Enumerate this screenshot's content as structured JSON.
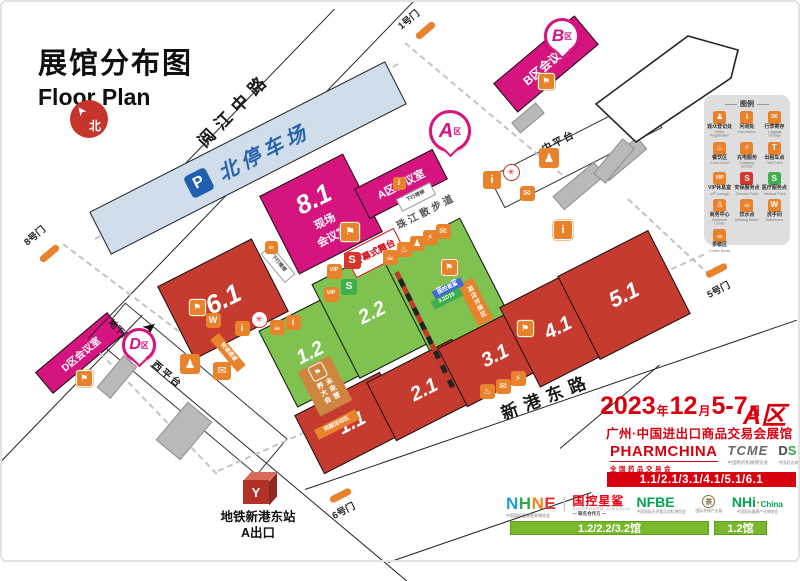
{
  "title": {
    "zh": "展馆分布图",
    "en": "Floor Plan"
  },
  "compass": "北",
  "roads": {
    "yuejiang": "阅江中路",
    "xingang": "新港东路",
    "promenade": "珠江散步道",
    "west_platform": "西平台",
    "mid_platform": "中平台",
    "underground_parking": "地下停车场"
  },
  "parking": {
    "p": "P",
    "label": "北停车场"
  },
  "map": {
    "hall81": "8.1",
    "halls": [
      {
        "label": "6.1",
        "color": "red"
      },
      {
        "label": "1.2",
        "color": "green"
      },
      {
        "label": "2.2",
        "color": "green"
      },
      {
        "label": "3.2",
        "color": "green"
      },
      {
        "label": "1.1",
        "color": "red"
      },
      {
        "label": "2.1",
        "color": "red"
      },
      {
        "label": "3.1",
        "color": "red"
      },
      {
        "label": "4.1",
        "color": "red"
      },
      {
        "label": "5.1",
        "color": "red"
      }
    ],
    "gates": [
      "8号门",
      "1号门",
      "5号门",
      "6号门"
    ],
    "balloons": [
      {
        "letter": "A",
        "suffix": "区"
      },
      {
        "letter": "B",
        "suffix": "区"
      },
      {
        "letter": "D",
        "suffix": "区"
      }
    ],
    "conference": {
      "a": "A区会议室",
      "b": "B区会议室",
      "d": "D区会议室",
      "onsite_line1": "现场",
      "onsite_line2": "会议室"
    },
    "tags": [
      {
        "text": "开幕式舞台",
        "type": "stage"
      },
      {
        "text": "下行楼梯",
        "type": "esc"
      },
      {
        "text": "下行楼梯",
        "type": "esc"
      },
      {
        "text": "快速通道",
        "type": "otag"
      },
      {
        "text": "同期活动区",
        "type": "otag"
      },
      {
        "text": "酒店对接区",
        "type": "otagv"
      },
      {
        "text": "国控星鲨",
        "type": "btag"
      },
      {
        "text": "3.2D16",
        "type": "gtag"
      }
    ],
    "future_box": {
      "label": "未来营养大会"
    },
    "icons": [
      {
        "n": "host-icon",
        "g": "⚑",
        "b": 1
      },
      {
        "n": "washroom-icon",
        "g": "W"
      },
      {
        "n": "info-icon",
        "g": "i"
      },
      {
        "n": "emblem-icon",
        "g": "✳",
        "c": "emblem"
      },
      {
        "n": "cafe-icon",
        "g": "☕"
      },
      {
        "n": "info-icon",
        "g": "i"
      },
      {
        "n": "registration-icon",
        "g": "♟",
        "s": 20
      },
      {
        "n": "luggage-icon",
        "g": "✉",
        "s": 18
      },
      {
        "n": "security-icon",
        "g": "S",
        "c": "red",
        "s": 17
      },
      {
        "n": "vip-icon",
        "g": "VIP",
        "vip": 1
      },
      {
        "n": "medical-icon",
        "g": "S",
        "c": "green",
        "s": 16
      },
      {
        "n": "vip-icon",
        "g": "VIP",
        "vip": 1
      },
      {
        "n": "cafe-icon",
        "g": "☕"
      },
      {
        "n": "food-icon",
        "g": "♨"
      },
      {
        "n": "registration-icon",
        "g": "♟"
      },
      {
        "n": "charging-icon",
        "g": "⚡"
      },
      {
        "n": "luggage-icon",
        "g": "✉"
      },
      {
        "n": "info-icon",
        "g": "i",
        "s": 18
      },
      {
        "n": "emblem-icon",
        "g": "✳",
        "c": "emblem"
      },
      {
        "n": "luggage-icon",
        "g": "✉"
      },
      {
        "n": "registration-icon",
        "g": "♟",
        "s": 20
      },
      {
        "n": "host-icon",
        "g": "⚑",
        "b": 1
      },
      {
        "n": "host-icon",
        "g": "⚑",
        "b": 1,
        "s": 18
      },
      {
        "n": "host-icon",
        "g": "⚑",
        "b": 1
      },
      {
        "n": "host-icon",
        "g": "⚑",
        "b": 1
      },
      {
        "n": "info-icon",
        "g": "i",
        "b": 1,
        "s": 18
      },
      {
        "n": "host-icon",
        "g": "⚑",
        "b": 1
      },
      {
        "n": "food-icon",
        "g": "♨"
      },
      {
        "n": "luggage-icon",
        "g": "✉"
      },
      {
        "n": "charging-icon",
        "g": "⚡"
      },
      {
        "n": "cafe-icon",
        "g": "☕",
        "s": 13
      },
      {
        "n": "info-icon",
        "g": "i",
        "s": 13
      }
    ],
    "metro": {
      "station": "地铁新港东站",
      "exit": "A出口",
      "logo": "Y"
    }
  },
  "legend": {
    "title": "图例",
    "items": [
      {
        "zh": "观众登记处",
        "en": "Visitor Registration",
        "g": "♟",
        "c": ""
      },
      {
        "zh": "问询处",
        "en": "Information",
        "g": "i",
        "c": ""
      },
      {
        "zh": "行李寄存",
        "en": "Luggage Storage",
        "g": "✉",
        "c": ""
      },
      {
        "zh": "餐饮区",
        "en": "Food Court",
        "g": "♨",
        "c": ""
      },
      {
        "zh": "充电服务",
        "en": "Charging Service",
        "g": "⚡",
        "c": ""
      },
      {
        "zh": "出租车点",
        "en": "Taxi Point",
        "g": "T",
        "c": ""
      },
      {
        "zh": "VIP休息室",
        "en": "VIP Lounge",
        "g": "VIP",
        "c": ""
      },
      {
        "zh": "安保服务点",
        "en": "Security Point",
        "g": "S",
        "c": "red"
      },
      {
        "zh": "医疗服务点",
        "en": "Medical Point",
        "g": "S",
        "c": "green"
      },
      {
        "zh": "商务中心",
        "en": "Business Center",
        "g": "♙",
        "c": ""
      },
      {
        "zh": "饮水点",
        "en": "Drinking Water",
        "g": "☕",
        "c": ""
      },
      {
        "zh": "洗手间",
        "en": "Washroom",
        "g": "W",
        "c": ""
      },
      {
        "zh": "茶歇区",
        "en": "Coffee Break",
        "g": "☕",
        "c": ""
      }
    ]
  },
  "info": {
    "date": [
      {
        "t": "2023",
        "big": true
      },
      {
        "t": "年"
      },
      {
        "t": "12",
        "big": true
      },
      {
        "t": "月"
      },
      {
        "t": "5-7",
        "big": true
      },
      {
        "t": "日"
      }
    ],
    "area": "A区",
    "venue": "广州·中国进出口商品交易会展馆",
    "brands1": {
      "pharm": {
        "name": "PHARMCHINA",
        "sub": "全国药品交易会"
      },
      "tcme": {
        "name": "TCME",
        "sub": "中国制药机械博览会"
      },
      "ds": {
        "d": "D",
        "s": "S",
        "sub": "中国药店商品交易会"
      }
    },
    "bar1": "1.1/2.1/3.1/4.1/5.1/6.1",
    "nhne": {
      "letters": [
        {
          "ch": "N",
          "c": "#1d9ed9"
        },
        {
          "ch": "H",
          "c": "#35a84c"
        },
        {
          "ch": "N",
          "c": "#f08519"
        },
        {
          "ch": "E",
          "c": "#e8312a"
        }
      ],
      "sub": "中国国际健康营养博览会"
    },
    "guokong": {
      "name": "国控星鲨",
      "sub1": "SINOPHARM XINGSHA",
      "sub2": "— 联名合作方 —"
    },
    "nfbe": {
      "name": "NFBE",
      "sub": "中国国际天然食品饮料博览会"
    },
    "tea": {
      "glyph": "茶",
      "sub": "国际茶咖产业展"
    },
    "nhi": {
      "name": "NHi",
      "name2": "China",
      "sub": "中国国际健康产业博览会"
    },
    "bar2": "1.2/2.2/3.2馆",
    "bar3": "1.2馆"
  }
}
